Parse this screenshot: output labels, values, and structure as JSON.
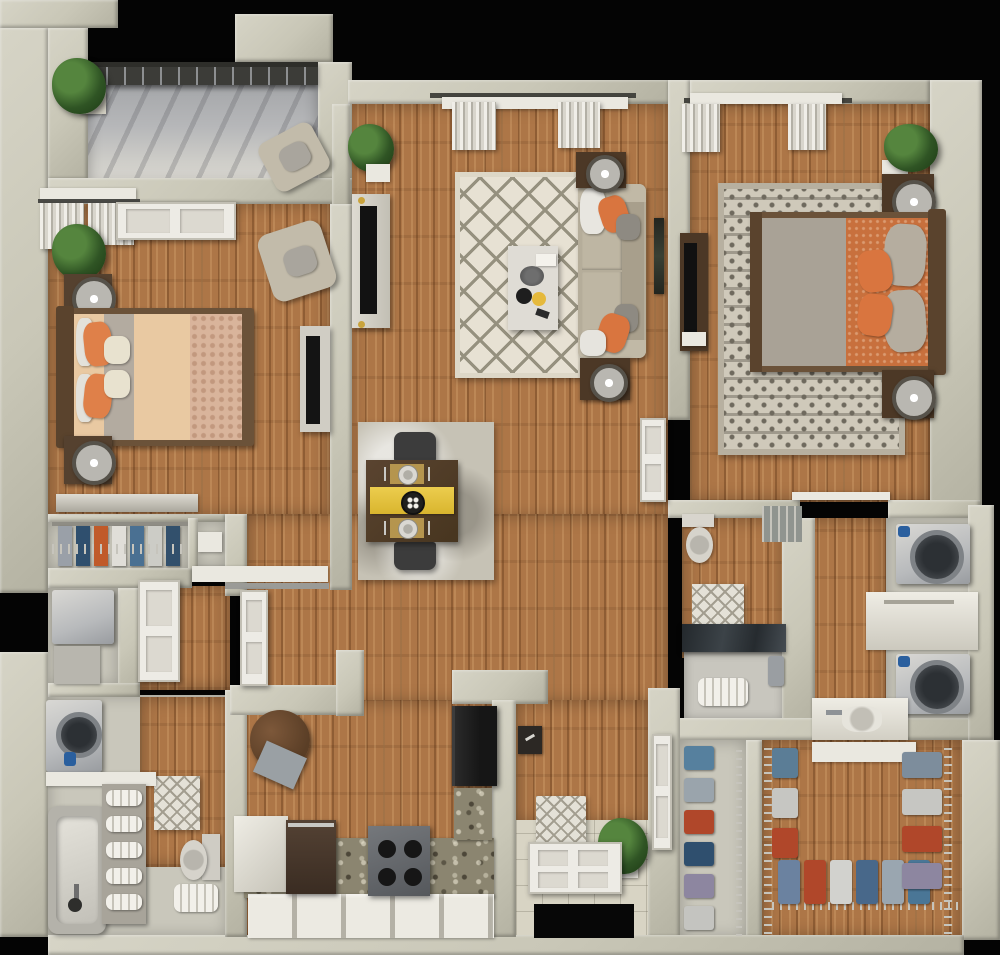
{
  "scene": {
    "title": "2 Bedroom / 2 Bathroom Apartment — 3D Floor Plan (Top-Down View)",
    "type": "3d-rendered-floorplan",
    "view": "top-down",
    "visible_text": "none",
    "background": "#000000"
  },
  "palette": {
    "walls": "#c9c7b7",
    "wood_floor": "#ad7647",
    "balcony_concrete": "#b9babc",
    "dark_wood_furniture": "#4c3826",
    "accent_orange": "#d9753f",
    "accent_yellow_runner": "#e6c33c",
    "rug_cream": "#e7e1d3",
    "sofa_beige": "#b5ad9a",
    "bedding_peach": "#e9c9a2",
    "comforter_orange": "#c8703d",
    "appliance_gray": "#b8babc",
    "shower_glass": "#2e3338",
    "plant_green": "#2f5424",
    "clothes_blue": "#56809e",
    "clothes_rust": "#b0472a",
    "clothes_navy": "#2f4f6e",
    "clothes_purple": "#8d86a0"
  },
  "rooms": [
    {
      "id": "balcony",
      "label": "Balcony / Patio",
      "furniture": [
        "metal railing",
        "lounge armchair",
        "potted plant"
      ]
    },
    {
      "id": "bedroom-1",
      "label": "Bedroom 1 (left)",
      "furniture": [
        "queen bed with peach bedding and orange pillows",
        "nightstand with lamp (x2)",
        "dresser",
        "TV console with flat TV",
        "accent armchair",
        "potted plant",
        "curtained window",
        "glazed door to balcony"
      ]
    },
    {
      "id": "living-room",
      "label": "Living Room (center)",
      "furniture": [
        "sofa with orange and gray pillows and white throw",
        "coffee table with books, bowl and yellow dish",
        "cream diamond-lattice rug",
        "TV console with flat TV",
        "end table with lamp (x2)",
        "potted plant",
        "curtained window",
        "wall art"
      ]
    },
    {
      "id": "bedroom-2",
      "label": "Bedroom 2 (right)",
      "furniture": [
        "queen bed with orange comforter and gray throw",
        "nightstand with lamp (x2)",
        "gray-cream patterned rug",
        "dresser with TV",
        "potted plant",
        "curtained window",
        "sliding closet door"
      ]
    },
    {
      "id": "dining-area",
      "label": "Dining Area",
      "furniture": [
        "dark wood table for two",
        "yellow table runner",
        "centerpiece plate",
        "place setting (x2)",
        "chair (x2)",
        "distressed gray rug"
      ]
    },
    {
      "id": "kitchen",
      "label": "Kitchen (L-shaped)",
      "furniture": [
        "4-burner range",
        "dishwasher",
        "refrigerator",
        "granite countertops",
        "white cabinet fronts",
        "round bistro table with chair"
      ]
    },
    {
      "id": "entry",
      "label": "Entry",
      "furniture": [
        "white panel front door (open)",
        "patterned doormat",
        "potted plant",
        "wall key box",
        "closet door"
      ]
    },
    {
      "id": "bathroom-1",
      "label": "Bathroom 1 (lower left)",
      "furniture": [
        "bathtub with faucet",
        "toilet",
        "linen shelf with rolled towels",
        "diamond bath mat",
        "stacked washer unit",
        "folded floor towels",
        "open panel door (x2)"
      ]
    },
    {
      "id": "bathroom-2",
      "label": "Bathroom 2 (right)",
      "furniture": [
        "glass-enclosed shower with towels",
        "toilet",
        "diamond bath mat",
        "wire storage shelf"
      ]
    },
    {
      "id": "laundry",
      "label": "Laundry Closet (right)",
      "furniture": [
        "front-load washer",
        "front-load dryer",
        "white storage cabinet",
        "vanity sink with faucet"
      ]
    },
    {
      "id": "walk-in-closet",
      "label": "Walk-in Closet (bottom right)",
      "furniture": [
        "wire shelving on three sides",
        "hanging clothes in blue, rust, gray and purple",
        "white storage box shelf"
      ]
    },
    {
      "id": "reach-in-closet",
      "label": "Hall Reach-in Closet",
      "furniture": [
        "wire shelving",
        "hanging clothes"
      ]
    },
    {
      "id": "bedroom-1-closet",
      "label": "Bedroom 1 Closet",
      "furniture": [
        "wire shelf",
        "hanging clothes",
        "side nook with tray"
      ]
    },
    {
      "id": "utility-closet",
      "label": "Utility Closet",
      "furniture": [
        "water heater"
      ]
    },
    {
      "id": "hallway",
      "label": "Hallways",
      "furniture": [
        "hardwood flooring"
      ]
    }
  ]
}
